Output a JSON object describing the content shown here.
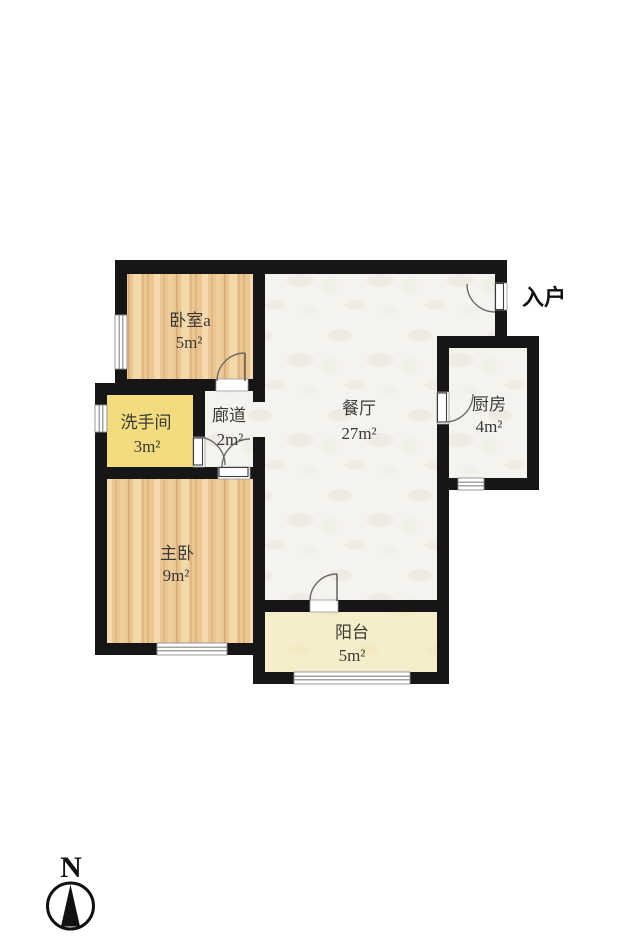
{
  "plan_type": "apartment-floor-plan",
  "rooms": [
    {
      "id": "bedroom-a",
      "name": "卧室a",
      "area": "5m²"
    },
    {
      "id": "bathroom",
      "name": "洗手间",
      "area": "3m²"
    },
    {
      "id": "corridor",
      "name": "廊道",
      "area": "2m²"
    },
    {
      "id": "dining",
      "name": "餐厅",
      "area": "27m²"
    },
    {
      "id": "kitchen",
      "name": "厨房",
      "area": "4m²"
    },
    {
      "id": "master-bedroom",
      "name": "主卧",
      "area": "9m²"
    },
    {
      "id": "balcony",
      "name": "阳台",
      "area": "5m²"
    }
  ],
  "annotations": {
    "entrance": "入户",
    "compass_north": "N"
  },
  "colors": {
    "wall": "#161616",
    "wood_floor": "#ebc692",
    "wood_streak_dark": "#d7a566",
    "wood_streak_light": "#f5ddb2",
    "bathroom_floor": "#f2dc7d",
    "tile_floor": "#f5f3ee",
    "balcony_floor": "#f6eecb",
    "door_arc": "#6b6b6b",
    "label_text": "#3a3a3a"
  }
}
